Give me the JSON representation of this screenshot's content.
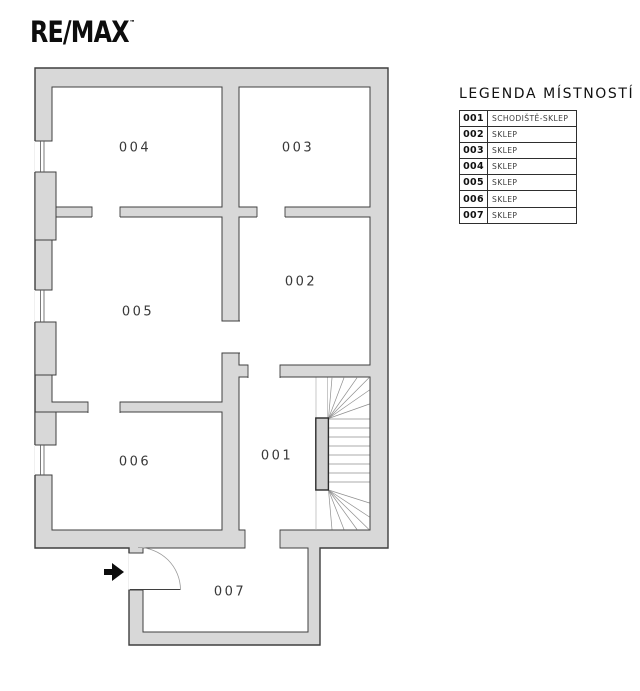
{
  "logo": {
    "text": "RE/MAX",
    "trademark": "™"
  },
  "legend": {
    "title": "LEGENDA MÍSTNOSTÍ",
    "rows": [
      {
        "number": "001",
        "name": "SCHODIŠTĚ-SKLEP"
      },
      {
        "number": "002",
        "name": "SKLEP"
      },
      {
        "number": "003",
        "name": "SKLEP"
      },
      {
        "number": "004",
        "name": "SKLEP"
      },
      {
        "number": "005",
        "name": "SKLEP"
      },
      {
        "number": "006",
        "name": "SKLEP"
      },
      {
        "number": "007",
        "name": "SKLEP"
      }
    ]
  },
  "plan": {
    "rooms": [
      {
        "id": "001",
        "label": "001",
        "type": "schodiště-sklep"
      },
      {
        "id": "002",
        "label": "002",
        "type": "sklep"
      },
      {
        "id": "003",
        "label": "003",
        "type": "sklep"
      },
      {
        "id": "004",
        "label": "004",
        "type": "sklep"
      },
      {
        "id": "005",
        "label": "005",
        "type": "sklep"
      },
      {
        "id": "006",
        "label": "006",
        "type": "sklep"
      },
      {
        "id": "007",
        "label": "007",
        "type": "sklep"
      }
    ],
    "features": [
      "entrance-arrow",
      "entrance-door-swing",
      "staircase",
      "windows-left-wall"
    ]
  },
  "colors": {
    "wall_fill": "#d8d8d8",
    "wall_outline": "#3f3f3f",
    "background": "#ffffff",
    "logo": "#0d0d0d",
    "stair_lines": "#8f8f8f"
  }
}
